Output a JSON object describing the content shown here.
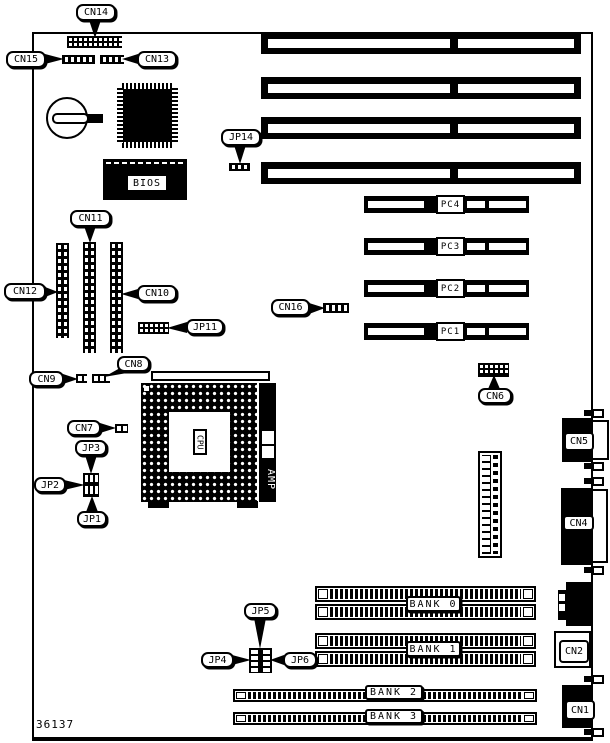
{
  "figure": {
    "part_number": "36137"
  },
  "labels": {
    "cn1": "CN1",
    "cn2": "CN2",
    "cn4": "CN4",
    "cn5": "CN5",
    "cn6": "CN6",
    "cn7": "CN7",
    "cn8": "CN8",
    "cn9": "CN9",
    "cn10": "CN10",
    "cn11": "CN11",
    "cn12": "CN12",
    "cn13": "CN13",
    "cn14": "CN14",
    "cn15": "CN15",
    "cn16": "CN16",
    "jp1": "JP1",
    "jp2": "JP2",
    "jp3": "JP3",
    "jp4": "JP4",
    "jp5": "JP5",
    "jp6": "JP6",
    "jp11": "JP11",
    "jp14": "JP14"
  },
  "chips": {
    "bios": "BIOS",
    "cpu": "CPU",
    "amp": "AMP"
  },
  "slots": {
    "pci": [
      "PC4",
      "PC3",
      "PC2",
      "PC1"
    ],
    "memory": [
      "BANK 0",
      "BANK 1",
      "BANK 2",
      "BANK 3"
    ]
  }
}
